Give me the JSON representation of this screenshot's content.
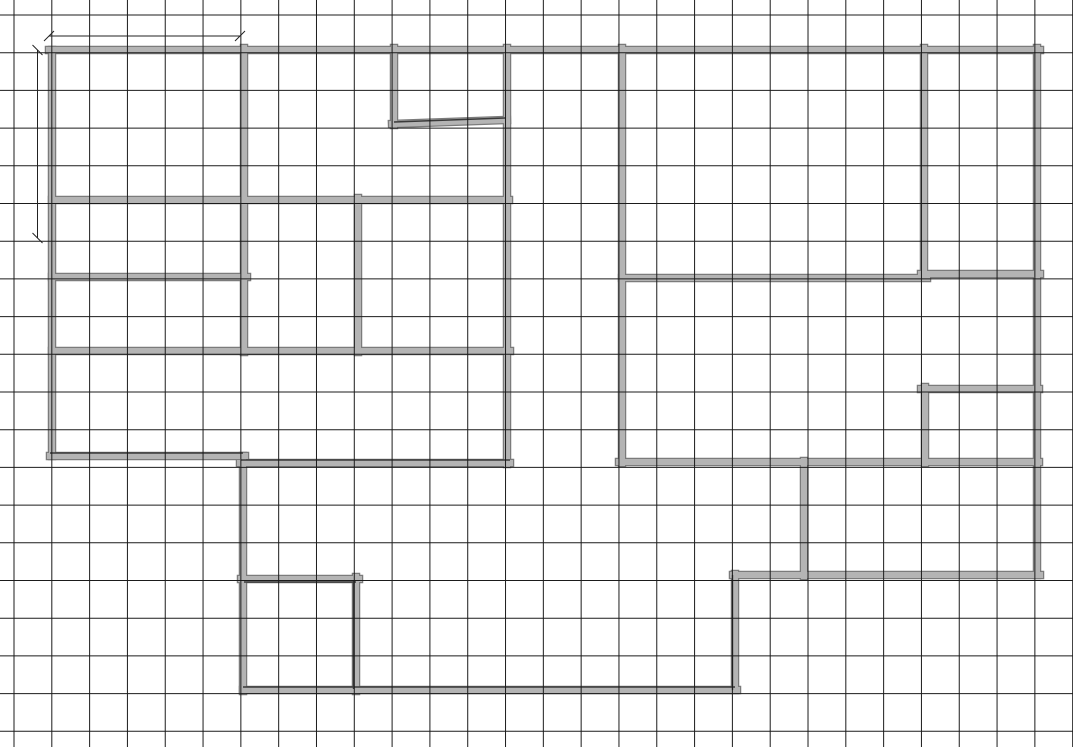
{
  "canvas": {
    "width": 1073,
    "height": 747,
    "background": "#ffffff"
  },
  "grid": {
    "origin_x": 14,
    "origin_y": 15,
    "spacing_x": 37.81,
    "spacing_y": 37.7,
    "color": "#1b1b1b",
    "line_width": 1
  },
  "style": {
    "wall_fill": "#b4b4b4",
    "wall_outline": "#7b7b7b",
    "wall_thickness": 6,
    "wall_outline_thickness": 8.5,
    "accent_color": "#3a3a3a",
    "accent_width": 1.4,
    "dim_color": "#222222",
    "dim_width": 1,
    "tick_half": 5
  },
  "walls": [
    {
      "name": "top-outer-wall",
      "x1": 49,
      "y1": 50,
      "x2": 1040,
      "y2": 50
    },
    {
      "name": "left-outer-wall",
      "x1": 52,
      "y1": 50,
      "x2": 52,
      "y2": 456
    },
    {
      "name": "lower-left-outer-wall",
      "x1": 50,
      "y1": 456,
      "x2": 245,
      "y2": 456
    },
    {
      "name": "left-lower-outer-wall",
      "x1": 243,
      "y1": 456,
      "x2": 243,
      "y2": 691
    },
    {
      "name": "bottom-outer-wall",
      "x1": 243,
      "y1": 690,
      "x2": 737,
      "y2": 690
    },
    {
      "name": "bottom-step-wall",
      "x1": 735,
      "y1": 690,
      "x2": 735,
      "y2": 574
    },
    {
      "name": "bottom-right-outer-wall",
      "x1": 733,
      "y1": 575,
      "x2": 1040,
      "y2": 575
    },
    {
      "name": "right-outer-wall",
      "x1": 1037,
      "y1": 575,
      "x2": 1037,
      "y2": 48
    },
    {
      "name": "topleft-room-divider-wall",
      "x1": 244,
      "y1": 48,
      "x2": 244,
      "y2": 352
    },
    {
      "name": "upperleft-horizontal-wall",
      "x1": 52,
      "y1": 200,
      "x2": 509,
      "y2": 200
    },
    {
      "name": "leftroom-divider-wall",
      "x1": 52,
      "y1": 277,
      "x2": 247,
      "y2": 277
    },
    {
      "name": "midleft-divider-wall",
      "x1": 52,
      "y1": 351,
      "x2": 510,
      "y2": 351
    },
    {
      "name": "midroom-divider-wall",
      "x1": 358,
      "y1": 198,
      "x2": 358,
      "y2": 352
    },
    {
      "name": "hallway-left-wall",
      "x1": 507,
      "y1": 48,
      "x2": 507,
      "y2": 464
    },
    {
      "name": "midleft-bottom-wall",
      "x1": 240,
      "y1": 463,
      "x2": 510,
      "y2": 463
    },
    {
      "name": "notch-left-wall",
      "x1": 394,
      "y1": 48,
      "x2": 394,
      "y2": 125
    },
    {
      "name": "notch-bottom-wall",
      "x1": 392,
      "y1": 124,
      "x2": 507,
      "y2": 120
    },
    {
      "name": "hallway-right-wall",
      "x1": 622,
      "y1": 48,
      "x2": 622,
      "y2": 463
    },
    {
      "name": "upperright-bottom-wall",
      "x1": 619,
      "y1": 462,
      "x2": 1039,
      "y2": 462
    },
    {
      "name": "upperright-divider-left-wall",
      "x1": 622,
      "y1": 278,
      "x2": 927,
      "y2": 278
    },
    {
      "name": "upperright-divider-right-wall",
      "x1": 921,
      "y1": 274,
      "x2": 1040,
      "y2": 274
    },
    {
      "name": "upperright-vertical-wall",
      "x1": 924,
      "y1": 48,
      "x2": 924,
      "y2": 276
    },
    {
      "name": "smallright-room-top-wall",
      "x1": 921,
      "y1": 389,
      "x2": 1039,
      "y2": 389
    },
    {
      "name": "smallright-room-left-wall",
      "x1": 925,
      "y1": 387,
      "x2": 925,
      "y2": 463
    },
    {
      "name": "lowerright-divider-wall",
      "x1": 804,
      "y1": 461,
      "x2": 804,
      "y2": 576
    },
    {
      "name": "small-bottomleft-room-top-wall",
      "x1": 241,
      "y1": 579,
      "x2": 359,
      "y2": 579
    },
    {
      "name": "small-bottomleft-room-right-wall",
      "x1": 356,
      "y1": 577,
      "x2": 356,
      "y2": 691
    }
  ],
  "accent_lines": [
    {
      "name": "bottom-wall-pencil-edge",
      "x1": 243,
      "y1": 687,
      "x2": 735,
      "y2": 687
    },
    {
      "name": "step-wall-pencil-edge",
      "x1": 732.5,
      "y1": 575,
      "x2": 732.5,
      "y2": 690
    },
    {
      "name": "midleft-bottom-pencil-edge",
      "x1": 241,
      "y1": 460,
      "x2": 510,
      "y2": 460
    },
    {
      "name": "notch-bottom-pencil-edge",
      "x1": 394,
      "y1": 122,
      "x2": 505,
      "y2": 118
    },
    {
      "name": "smallroom-top-pencil-edge",
      "x1": 244,
      "y1": 582,
      "x2": 356,
      "y2": 582
    },
    {
      "name": "smallroom-right-pencil-edge",
      "x1": 353.5,
      "y1": 580,
      "x2": 353.5,
      "y2": 689
    },
    {
      "name": "lowerleft-wall-pencil-edge",
      "x1": 50,
      "y1": 453,
      "x2": 243,
      "y2": 453
    }
  ],
  "dimensions": [
    {
      "name": "top-width-dimension",
      "x1": 49,
      "y1": 36,
      "x2": 240,
      "y2": 36,
      "tick": "slash"
    },
    {
      "name": "left-height-dimension",
      "x1": 37.5,
      "y1": 50,
      "x2": 37.5,
      "y2": 238,
      "tick": "backslash"
    }
  ]
}
